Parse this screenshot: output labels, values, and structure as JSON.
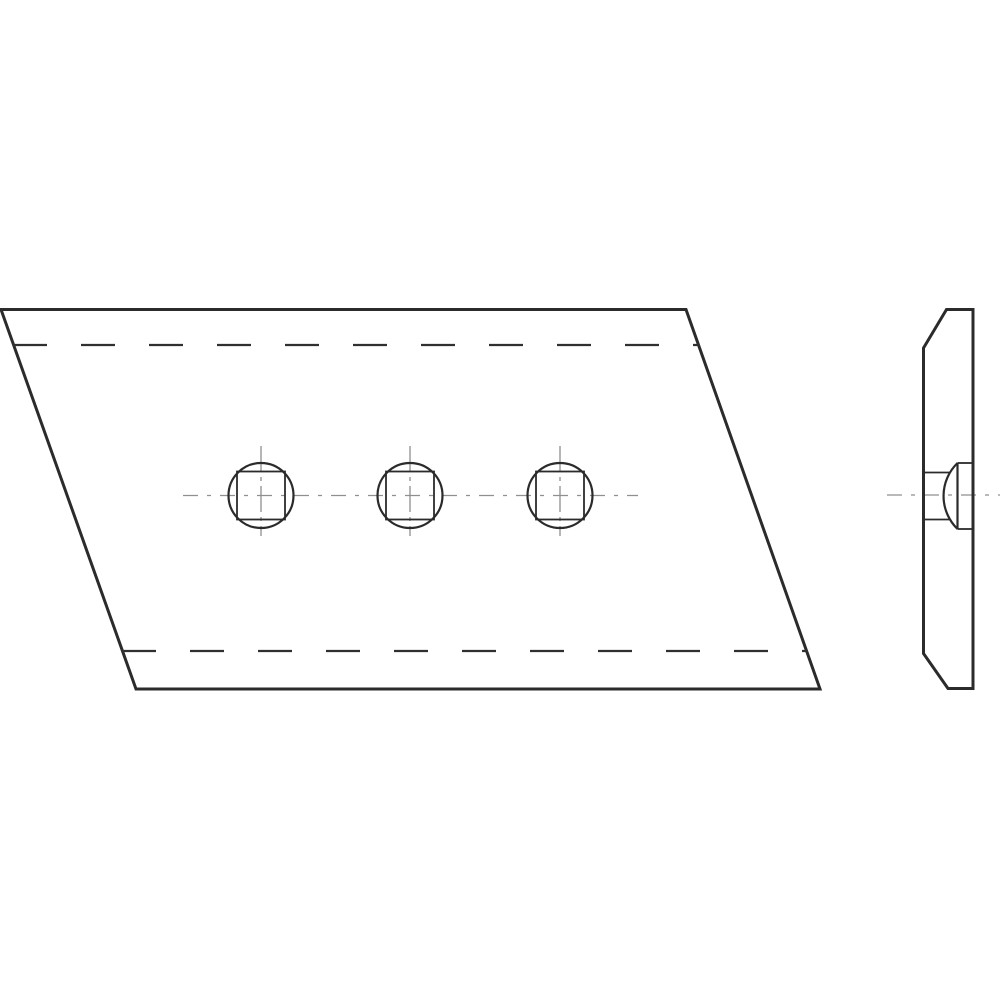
{
  "page": {
    "width": 1000,
    "height": 1000,
    "background": "#ffffff"
  },
  "drawing": {
    "type": "technical-drawing",
    "description": "Two-view engineering line drawing: front view of a parallelogram plate with three countersunk square bolt holes, and a right-side profile view of the plate with bolt seat",
    "colors": {
      "outline": "#2b2b2b",
      "dashed_line": "#303030",
      "centerline": "#8f8f8f"
    },
    "stroke_widths": {
      "outline": 3,
      "detail": 2.2,
      "square": 1.8,
      "dashed": 2.2,
      "centerline": 1.3
    },
    "front_view": {
      "outline_points": [
        [
          1,
          309.5
        ],
        [
          686,
          309.5
        ],
        [
          820,
          689
        ],
        [
          136,
          689
        ]
      ],
      "bend_lines": [
        {
          "name": "top-bend-dashed-line",
          "x1": 13,
          "y1": 345,
          "x2": 699,
          "y2": 345
        },
        {
          "name": "bottom-bend-dashed-line",
          "x1": 122,
          "y1": 651,
          "x2": 807,
          "y2": 651
        }
      ],
      "bend_dash_pattern": "34 34",
      "holes": {
        "centers_x": [
          261,
          410,
          560
        ],
        "center_y": 495.5,
        "circle_radius": 32.5,
        "square_size": 48
      },
      "horizontal_centerline": {
        "x1": 183,
        "y1": 495.5,
        "x2": 638,
        "y2": 495.5
      },
      "vertical_centerline_extent": {
        "y1": 446,
        "y2": 536
      },
      "horizontal_centerline_dash": "15 9 4 9",
      "vertical_centerline_dash": "26 5 4 5"
    },
    "side_view": {
      "outline_points": [
        [
          946.5,
          309.5
        ],
        [
          973,
          309.5
        ],
        [
          973,
          688.5
        ],
        [
          948,
          688.5
        ],
        [
          923.5,
          653.5
        ],
        [
          923.5,
          348
        ]
      ],
      "bolt_seat": {
        "neck_lines": [
          {
            "name": "bolt-seat-neck-top-line",
            "x1": 923.5,
            "y1": 472.5,
            "x2": 949.5,
            "y2": 472.5
          },
          {
            "name": "bolt-seat-neck-bottom-line",
            "x1": 923.5,
            "y1": 519.5,
            "x2": 949.5,
            "y2": 519.5
          }
        ],
        "base_line": {
          "x1": 957.5,
          "y1": 463,
          "x2": 957.5,
          "y2": 529
        },
        "counterbore_lines": [
          {
            "name": "counterbore-top-line",
            "x1": 957.5,
            "y1": 463,
            "x2": 973,
            "y2": 463
          },
          {
            "name": "counterbore-bottom-line",
            "x1": 957.5,
            "y1": 529,
            "x2": 973,
            "y2": 529
          }
        ],
        "dome_arc": {
          "from": [
            957.5,
            463
          ],
          "to": [
            957.5,
            529
          ],
          "radius": 46,
          "sweep": 0
        }
      },
      "centerline": {
        "x1": 887,
        "y1": 495,
        "x2": 1000,
        "y2": 495
      },
      "centerline_dash": "15 9 4 9"
    }
  }
}
